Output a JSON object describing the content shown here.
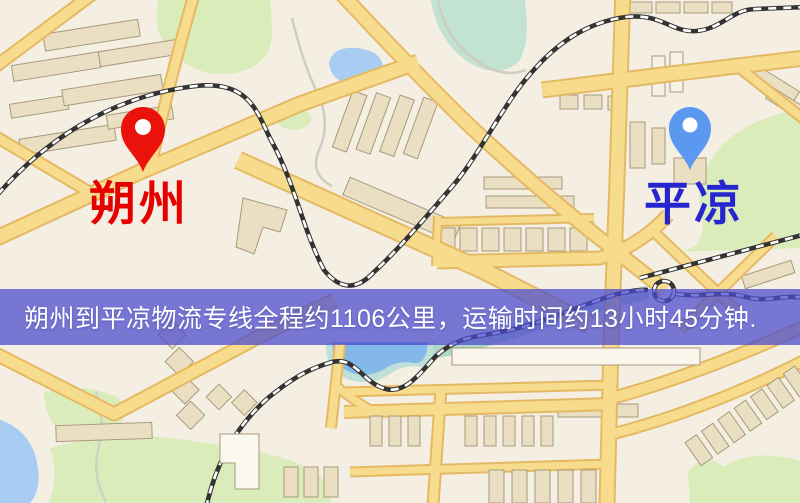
{
  "map": {
    "markers": [
      {
        "id": "origin",
        "label": "朔州",
        "label_color": "#e60000",
        "pin_color": "#ea130b"
      },
      {
        "id": "destination",
        "label": "平凉",
        "label_color": "#2626d0",
        "pin_color": "#5b99f0"
      }
    ],
    "banner": {
      "text": "朔州到平凉物流专线全程约1106公里，运输时间约13小时45分钟.",
      "background_color": "#4b4bcd",
      "text_color": "#ffffff"
    },
    "route": {
      "origin": "朔州",
      "destination": "平凉",
      "distance_text": "全程约1106公里",
      "duration_text": "运输时间约13小时45分钟"
    },
    "palette": {
      "background": "#f4efe2",
      "road_fill": "#f8dc8e",
      "road_edge": "#e5b963",
      "building": "#eadfc2",
      "building_edge": "#a79a7c",
      "park": "#d9ecba",
      "water": "#a9cdf2",
      "railway": "#333333"
    }
  }
}
